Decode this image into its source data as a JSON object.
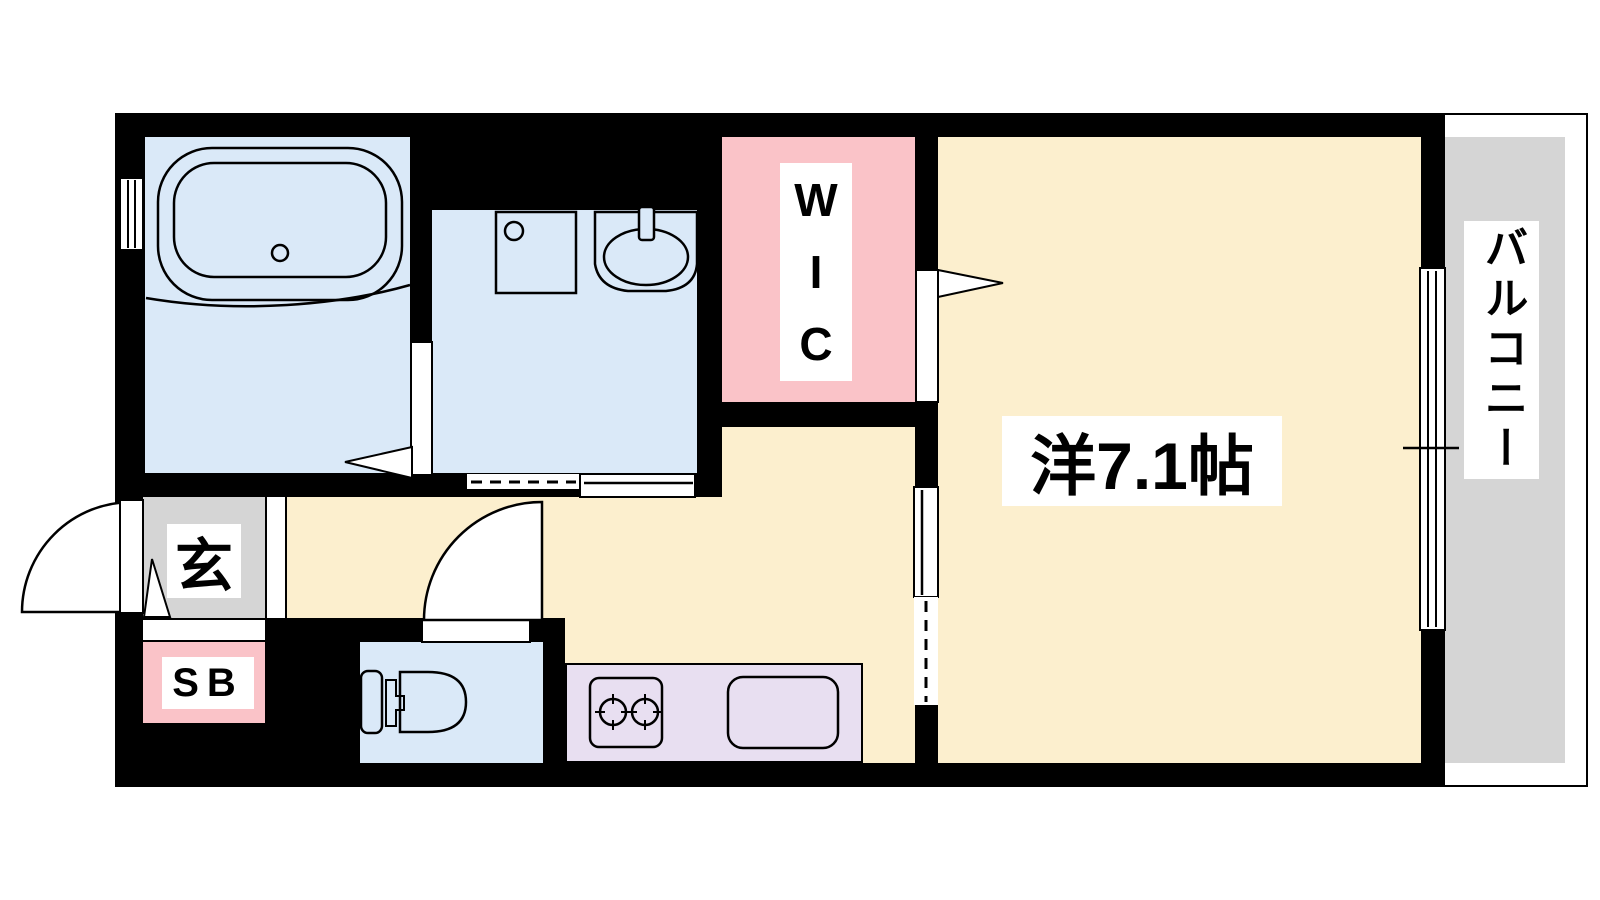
{
  "figure_type": "apartment-floor-plan",
  "colors": {
    "wall": "#000000",
    "background": "#ffffff",
    "wet_blue": "#dae9f8",
    "pink": "#fac3c8",
    "cream": "#fcefce",
    "lavender": "#e8dff1",
    "gray": "#d5d5d5",
    "label_text": "#000000",
    "label_bg": "#ffffff"
  },
  "labels": {
    "wic_letters": [
      "W",
      "I",
      "C"
    ],
    "main_room": "洋7.1帖",
    "balcony": "バルコニー",
    "entrance": "玄",
    "shoe_box": "SB"
  }
}
